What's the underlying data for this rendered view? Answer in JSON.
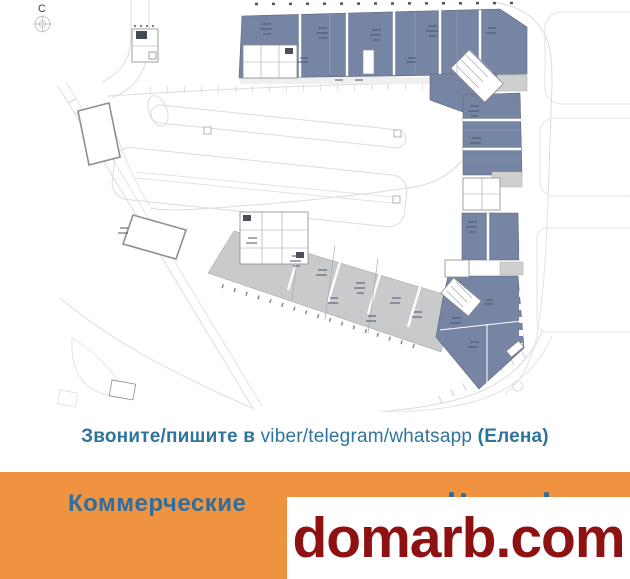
{
  "plan": {
    "compass_label": "С",
    "colors": {
      "building_fill": "#7585A3",
      "annex_fill": "#C9CACC",
      "road_line": "#DCDCDC",
      "outline_gray": "#8F8F8F",
      "dark_detail": "#49536A"
    }
  },
  "contact": {
    "prefix": "Звоните/пишите в",
    "apps": "viber/telegram/whatsapp",
    "contact_name": "(Елена)",
    "text_color": "#2F759B"
  },
  "banner": {
    "visible_text": "Коммерческие",
    "bg_color": "#EF9340",
    "text_color": "#2E6FA0"
  },
  "watermark": {
    "text": "domarb.com",
    "text_color": "#8E1212",
    "bg_color": "#FFFFFF"
  }
}
